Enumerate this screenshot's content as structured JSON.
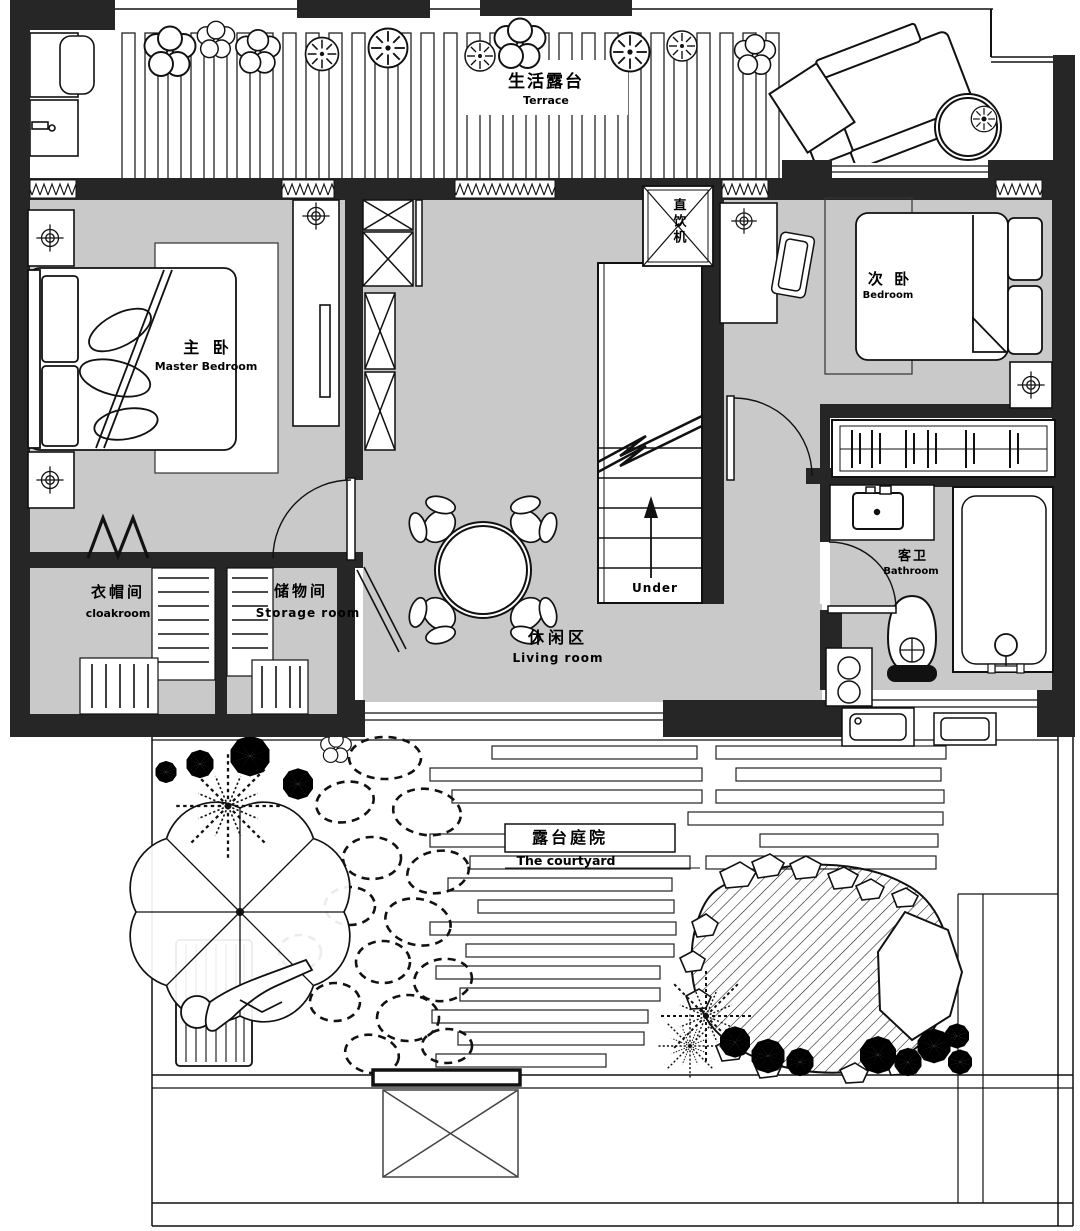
{
  "rooms": {
    "terrace": {
      "zh": "生活露台",
      "en": "Terrace"
    },
    "master": {
      "zh": "主 卧",
      "en": "Master Bedroom"
    },
    "bedroom2": {
      "zh": "次 卧",
      "en": "Bedroom"
    },
    "dispenser": {
      "zh": "直饮机"
    },
    "cloakroom": {
      "zh": "衣帽间",
      "en": "cloakroom"
    },
    "storage": {
      "zh": "储物间",
      "en": "Storage room"
    },
    "living": {
      "zh": "休闲区",
      "en": "Living room"
    },
    "bathroom": {
      "zh": "客卫",
      "en": "Bathroom"
    },
    "stairs": {
      "direction_label": "Under"
    },
    "courtyard": {
      "zh": "露台庭院",
      "en": "The courtyard"
    }
  },
  "colors": {
    "floor_gray": "#c9c9c9",
    "wall_black": "#262626",
    "line_black": "#111111",
    "background": "#ffffff"
  }
}
